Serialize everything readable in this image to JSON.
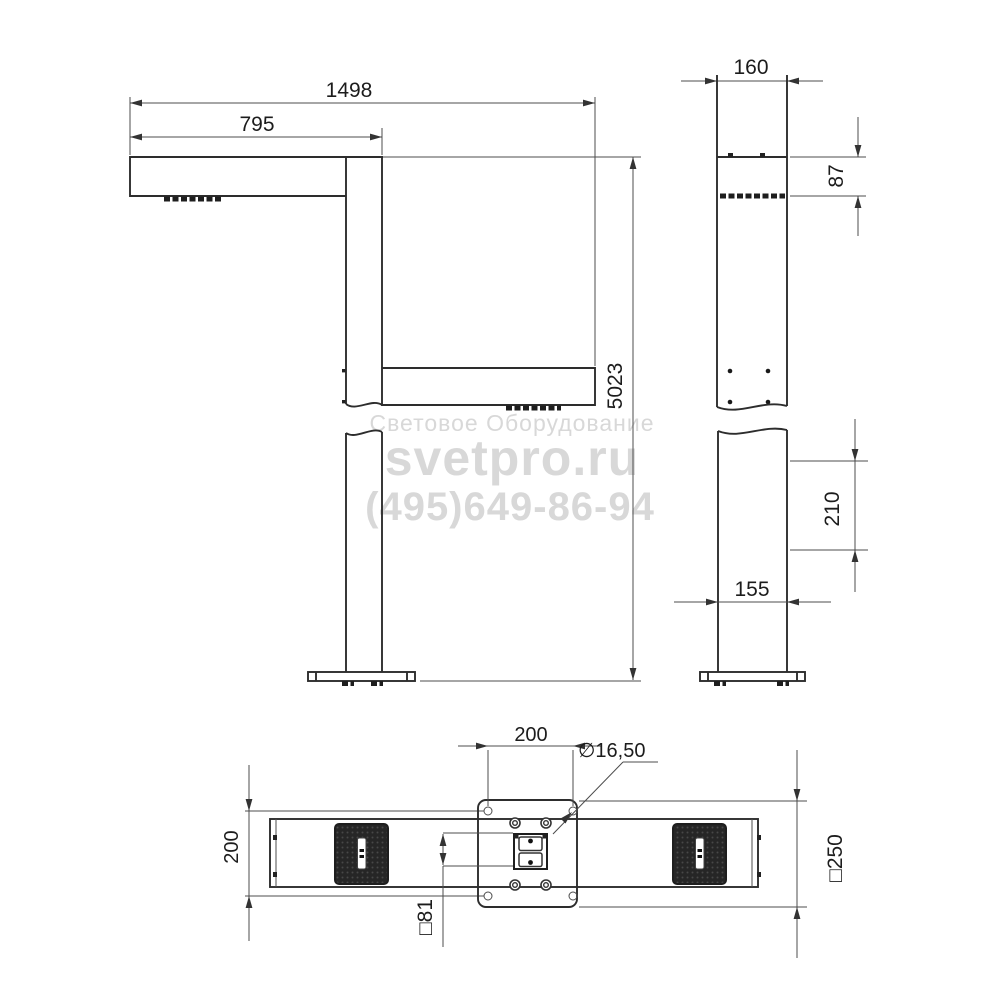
{
  "watermark": {
    "line1": "Световое Оборудование",
    "line2": "svetpro.ru",
    "line3": "(495)649-86-94",
    "color": "#d8d8d8"
  },
  "front_view": {
    "dim_total_arm_span": "1498",
    "dim_front_arm_length": "795",
    "dim_total_height": "5023"
  },
  "side_view": {
    "dim_pole_width_top": "160",
    "dim_arm_section_height": "87",
    "dim_bracket_offset": "210",
    "dim_pole_width_bottom": "155"
  },
  "bottom_view": {
    "dim_hole_spacing_horizontal": "200",
    "dim_hole_spacing_vertical": "200",
    "dim_hole_diameter": "∅16,50",
    "dim_plate_size": "□250",
    "dim_inner_square": "□81"
  },
  "colors": {
    "outline": "#2d2d2d",
    "dimension": "#4c4c4c",
    "led_fill": "#262626"
  }
}
